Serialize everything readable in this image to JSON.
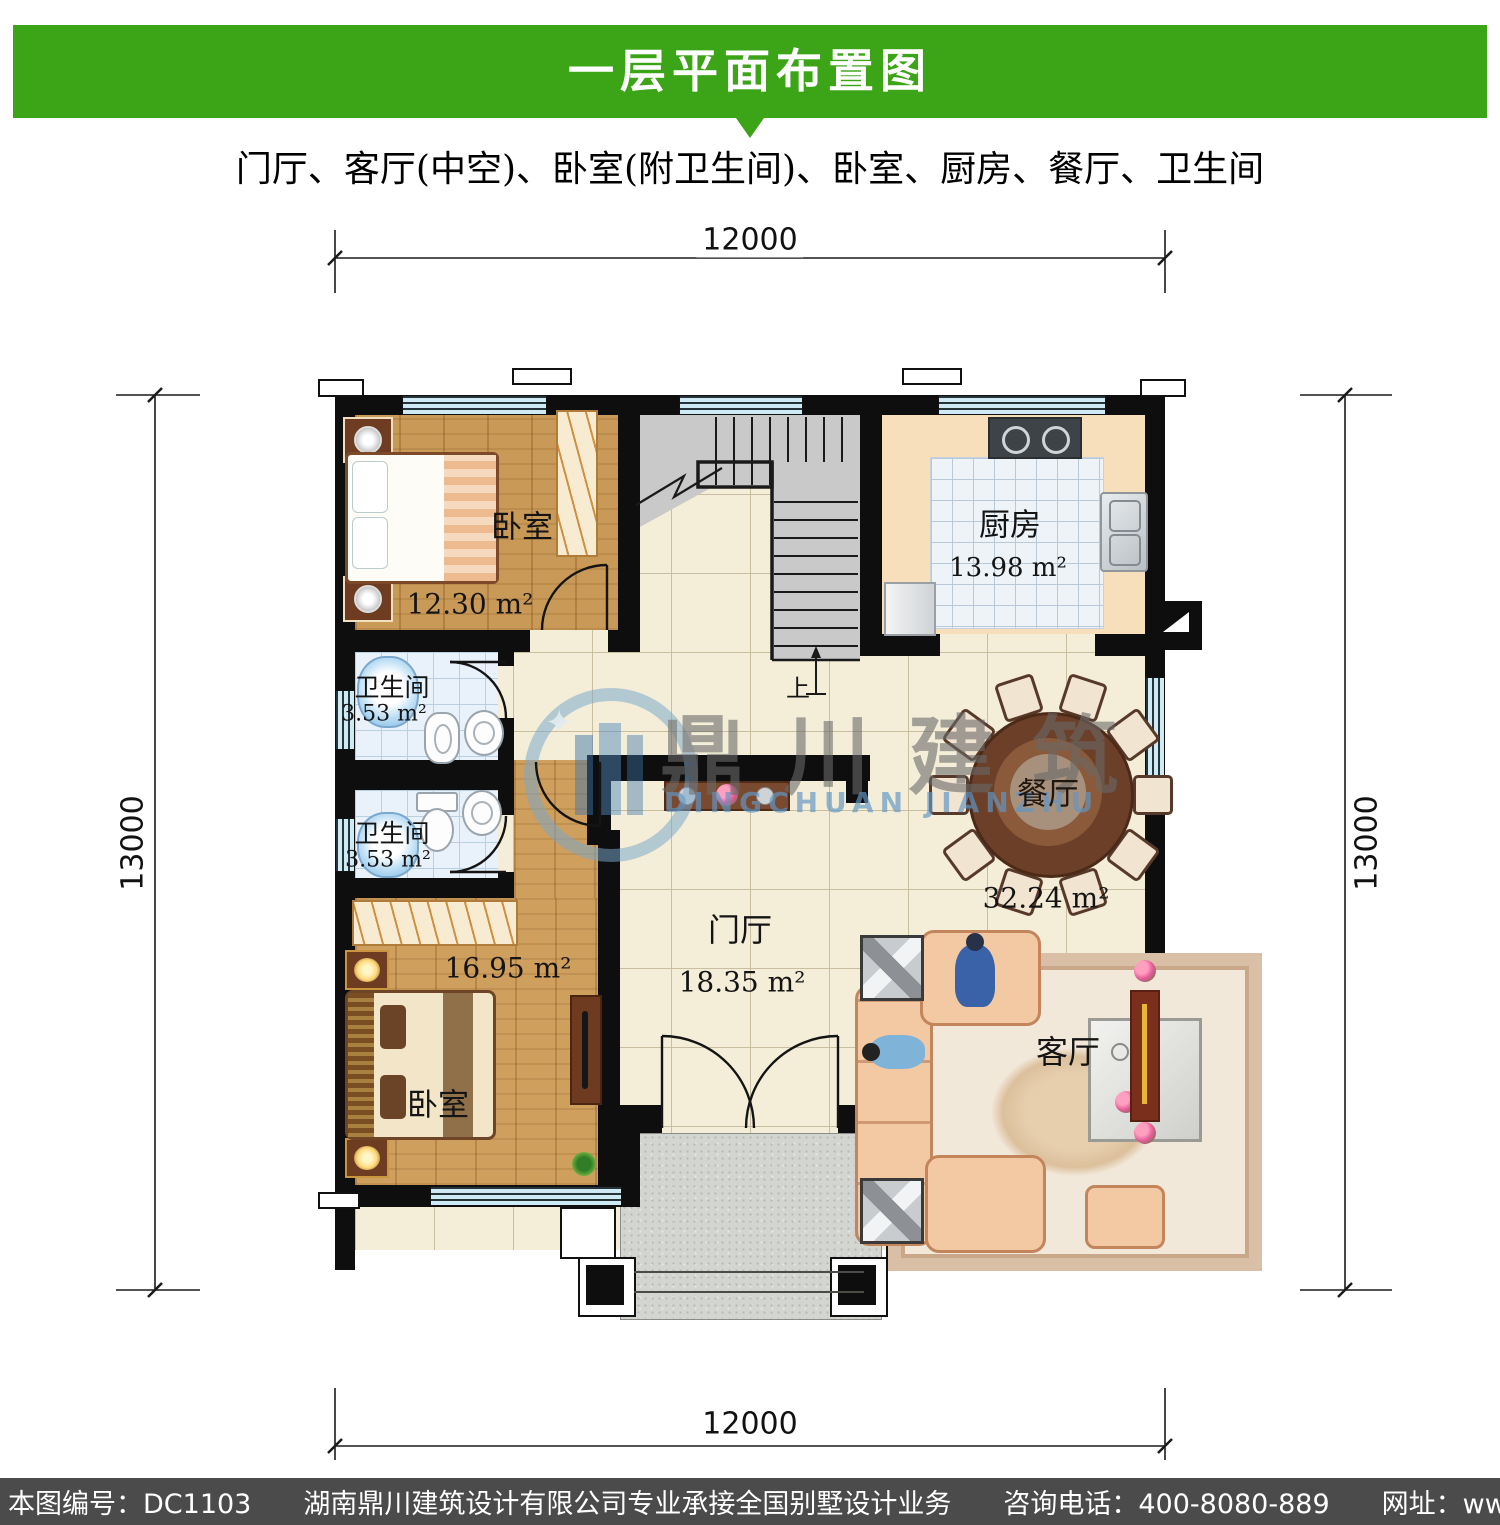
{
  "header": {
    "title": "一层平面布置图",
    "bar_color": "#3ba417"
  },
  "subtitle": "门厅、客厅(中空)、卧室(附卫生间)、卧室、厨房、餐厅、卫生间",
  "dimensions": {
    "top": "12000",
    "bottom": "12000",
    "left": "13000",
    "right": "13000"
  },
  "rooms": {
    "bedroom1": {
      "name": "卧室",
      "area": "12.30 m²"
    },
    "kitchen": {
      "name": "厨房",
      "area": "13.98 m²"
    },
    "bath1": {
      "name": "卫生间",
      "area": "3.53 m²"
    },
    "bath2": {
      "name": "卫生间",
      "area": "3.53 m²"
    },
    "bedroom2": {
      "name": "卧室",
      "area": "16.95 m²"
    },
    "foyer": {
      "name": "门厅",
      "area": "18.35 m²"
    },
    "dining": {
      "name": "餐厅",
      "area": "32.24 m²"
    },
    "living": {
      "name": "客厅"
    },
    "stairs": {
      "up_label": "上"
    }
  },
  "watermark": {
    "cn": "鼎川建筑",
    "en": "DINGCHUAN JIANZHU"
  },
  "footer": {
    "plan_no": "本图编号：DC1103",
    "company": "湖南鼎川建筑设计有限公司专业承接全国别墅设计业务",
    "phone": "咨询电话：400-8080-889",
    "website": "网址：www.bstzcs.com"
  }
}
